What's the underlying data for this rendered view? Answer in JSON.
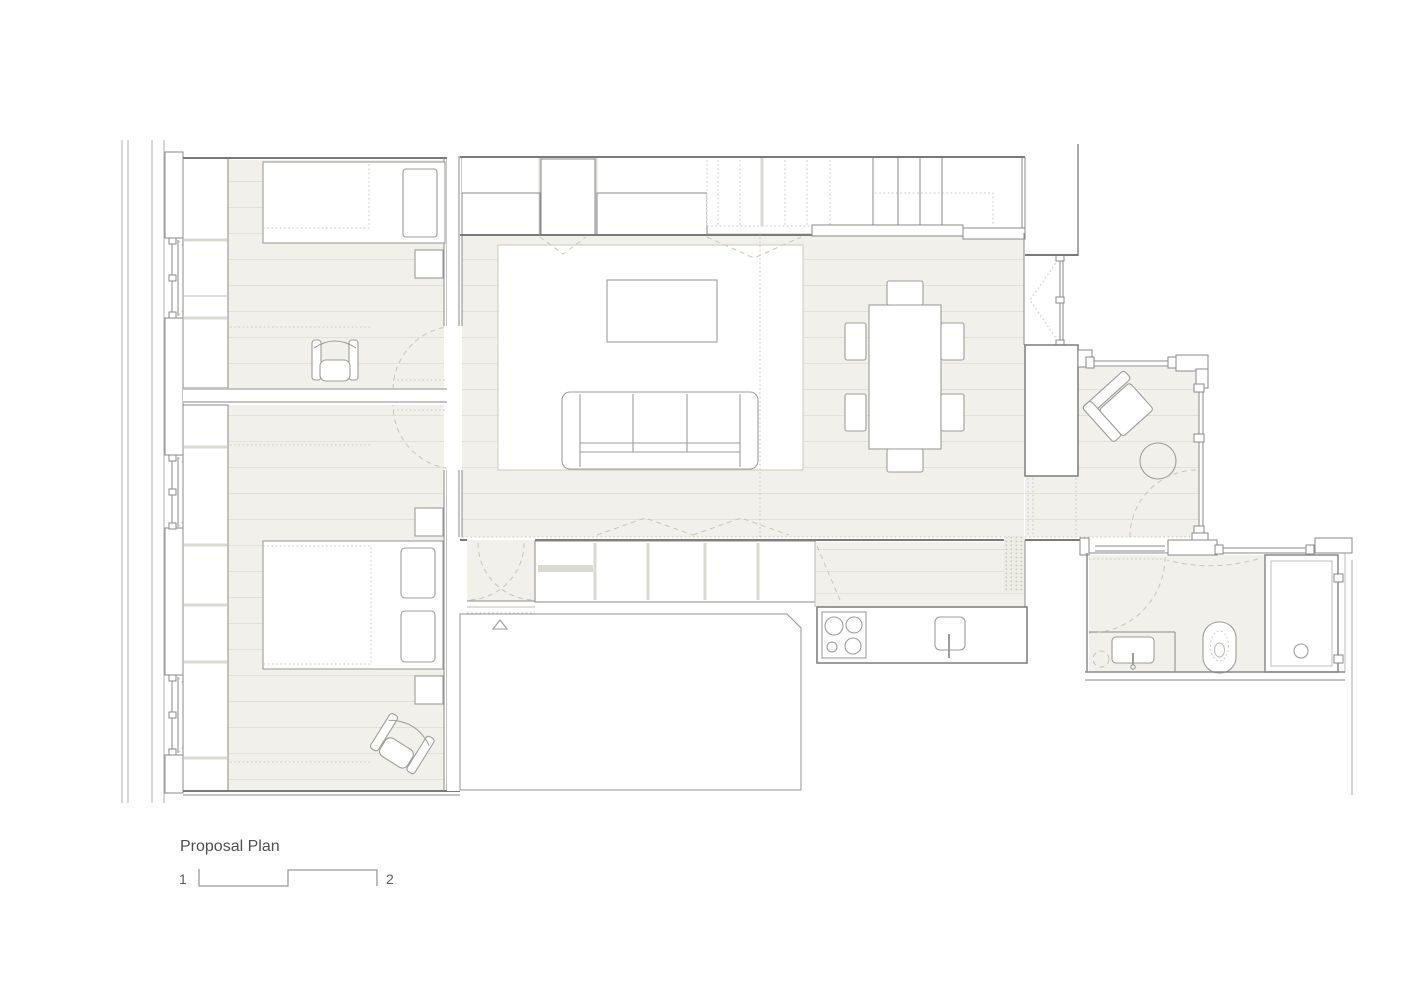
{
  "title_block": {
    "title": "Proposal Plan",
    "scale_start_label": "1",
    "scale_end_label": "2"
  },
  "colors": {
    "floor": "#f1f0ea",
    "plank": "#e2e1d8",
    "wall": "#8a8a8a",
    "wall-dark": "#7a7a7a",
    "line-light": "#bdbdb8",
    "facade": "#b2b2b0",
    "divider": "#dbdad2",
    "furniture": "#9d9d9a",
    "dashed": "#c7c6be",
    "rug-border": "#c9c8c0",
    "text": "#4f4f51",
    "text-light": "#5c5c5e"
  },
  "plan": {
    "type": "architectural-floor-plan",
    "rooms": [
      {
        "id": "bedroom-1",
        "elements": [
          "wardrobe",
          "single-bed",
          "pillow",
          "side-table",
          "armchair",
          "window",
          "door-swing"
        ]
      },
      {
        "id": "bedroom-2",
        "elements": [
          "wardrobe",
          "double-bed",
          "pillows",
          "nightstand-upper",
          "nightstand-lower",
          "armchair",
          "windows",
          "door-swing"
        ]
      },
      {
        "id": "living-room",
        "elements": [
          "storage-wall",
          "skylight-dashed",
          "staircase",
          "rug",
          "coffee-table",
          "sofa"
        ]
      },
      {
        "id": "dining-area",
        "elements": [
          "dining-table",
          "six-chairs",
          "window"
        ]
      },
      {
        "id": "terrace",
        "elements": [
          "glazing",
          "lounge-chair",
          "round-side-table",
          "door-swing"
        ]
      },
      {
        "id": "kitchen",
        "elements": [
          "cabinet-row",
          "counter",
          "hob",
          "sink"
        ]
      },
      {
        "id": "entry-vestibule",
        "elements": [
          "double-door-swing",
          "entry-triangle-marker"
        ]
      },
      {
        "id": "bathroom",
        "elements": [
          "vanity-sink",
          "toilet",
          "shower-tray",
          "door-swing",
          "glazing"
        ]
      }
    ]
  }
}
